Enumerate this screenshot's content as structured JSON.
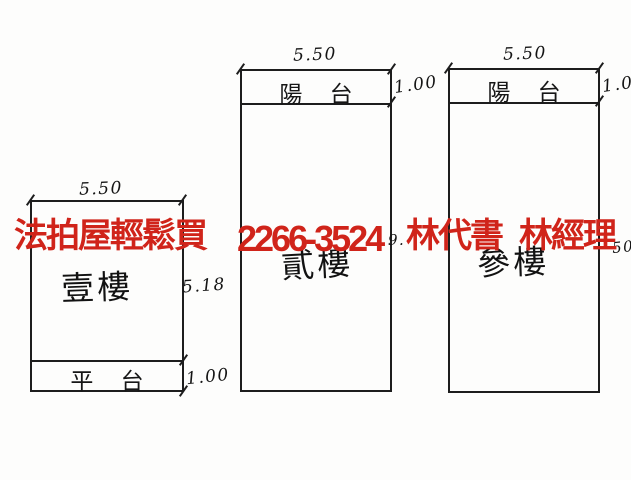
{
  "document": {
    "type": "scanned-floor-plan",
    "background_color": "#fdfdfc",
    "ink_color": "#1d1d1d"
  },
  "watermark": {
    "color": "#d0241a",
    "segments": [
      "法拍屋輕鬆買",
      "2266-3524",
      "林代書",
      "林經理"
    ]
  },
  "floors": [
    {
      "name": "first-floor",
      "room_label": "壹樓",
      "top_dimension": "5.50",
      "side_dimension": "5.18",
      "strip": {
        "label": "平 台",
        "dimension": "1.00",
        "position": "bottom"
      }
    },
    {
      "name": "second-floor",
      "room_label": "貳樓",
      "top_dimension": "5.50",
      "side_dimension_visible": "9.",
      "strip": {
        "label": "陽 台",
        "dimension": "1.00",
        "position": "top"
      }
    },
    {
      "name": "third-floor",
      "room_label": "參樓",
      "top_dimension": "5.50",
      "side_dimension_visible": "50",
      "strip": {
        "label": "陽 台",
        "dimension": "1.00",
        "position": "top"
      }
    }
  ]
}
